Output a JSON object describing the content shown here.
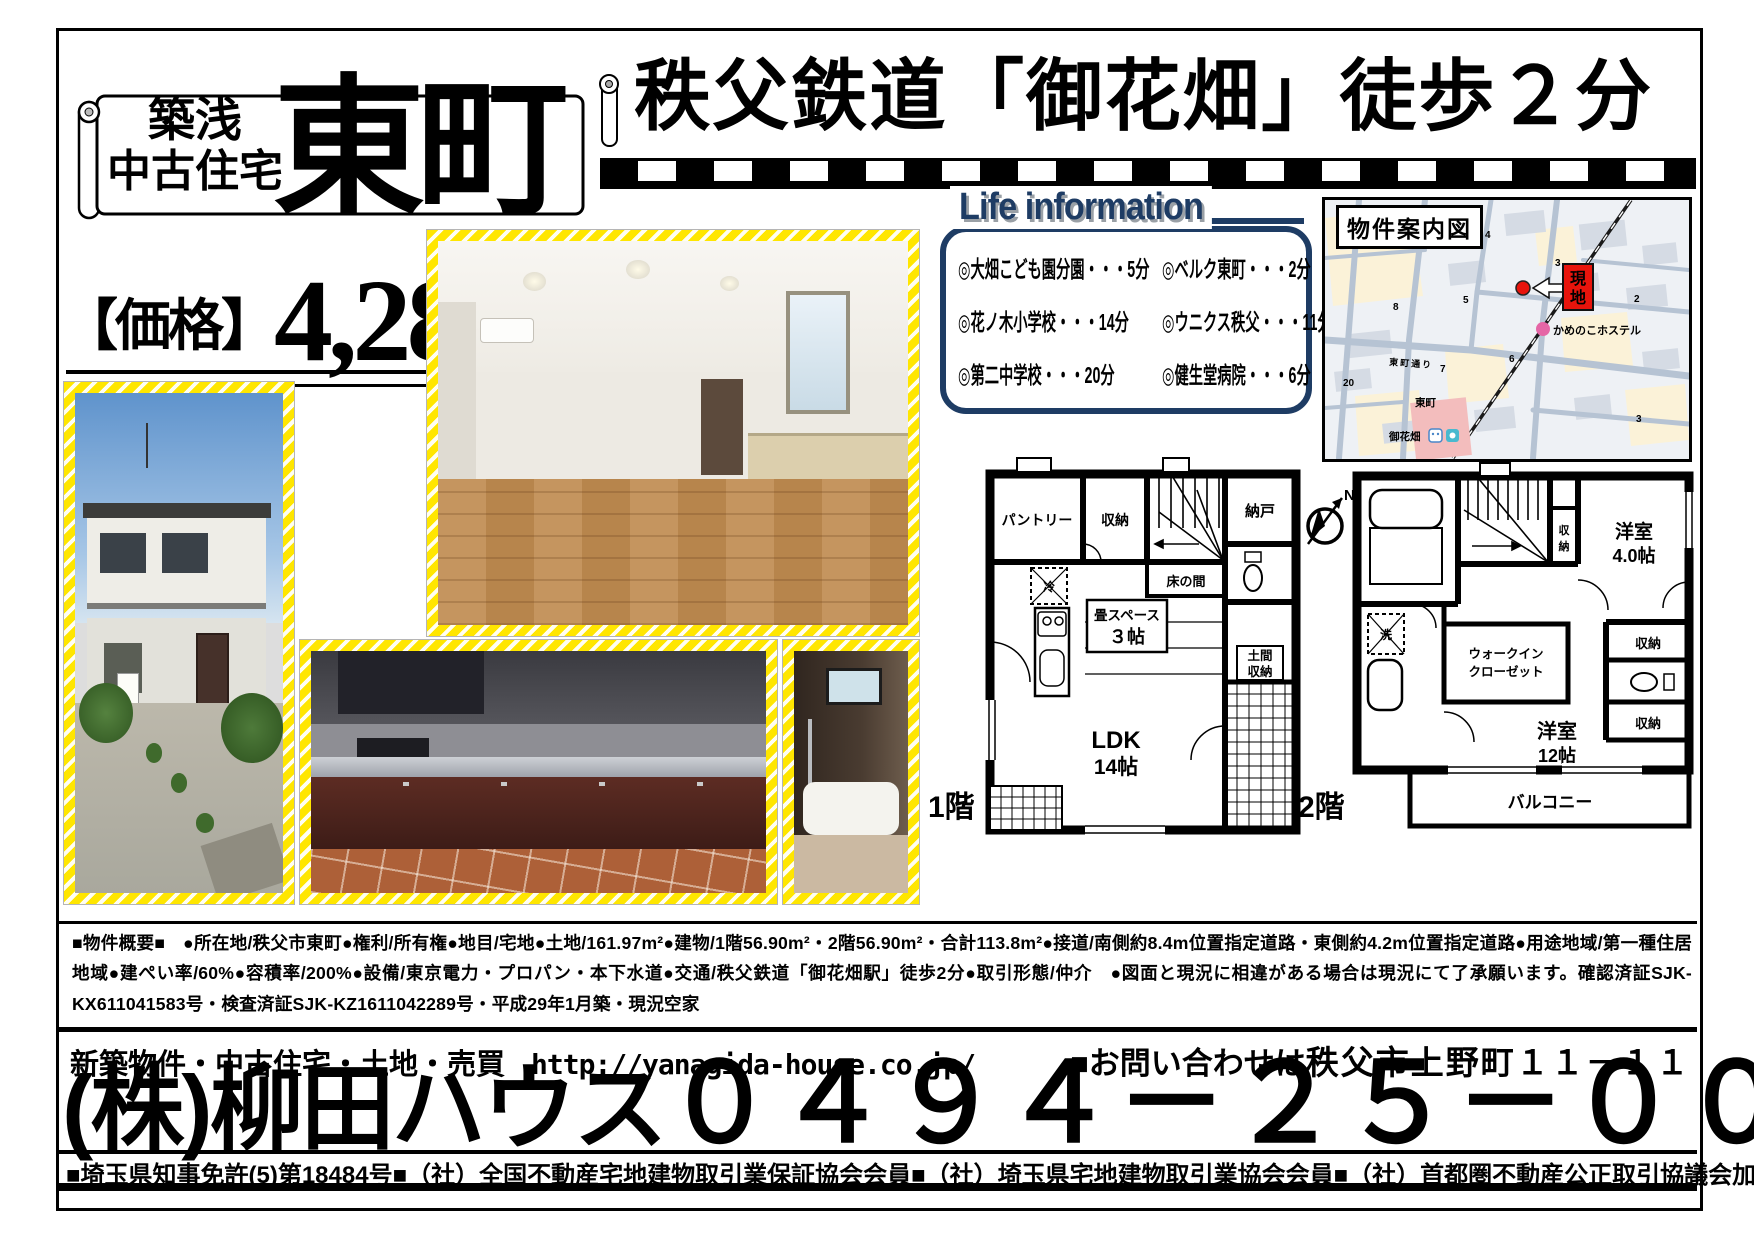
{
  "banner": {
    "tag1": "築浅",
    "tag2": "中古住宅",
    "name": "東町"
  },
  "headline": "秩父鉄道「御花畑」徒歩２分",
  "price": {
    "label": "【価格】",
    "amount": "4,280",
    "unit": "万円"
  },
  "life": {
    "title": "Life information",
    "rows": [
      {
        "l": "◎大畑こども園分園・・・5分",
        "r": "◎ベルク東町・・・2分"
      },
      {
        "l": "◎花ノ木小学校・・・14分",
        "r": "◎ウニクス秩父・・・11分"
      },
      {
        "l": "◎第二中学校・・・20分",
        "r": "◎健生堂病院・・・6分"
      }
    ]
  },
  "map": {
    "title": "物件案内図",
    "site_chars": [
      "現",
      "地"
    ],
    "hostel": "かめのこホステル",
    "town": "東町",
    "station": "御花畑",
    "road": "東町通り",
    "numbers": [
      "4",
      "5",
      "8",
      "3",
      "1",
      "2",
      "7",
      "6",
      "20",
      "3"
    ]
  },
  "compass": "N",
  "floor1": {
    "label": "1階",
    "pantry": "パントリー",
    "closet": "収納",
    "nando": "納戸",
    "tokonoma": "床の間",
    "tatami_1": "畳スペース",
    "tatami_2": "３帖",
    "fridge": "冷",
    "doma_1": "土間",
    "doma_2": "収納",
    "ldk_1": "LDK",
    "ldk_2": "14帖"
  },
  "floor2": {
    "label": "2階",
    "room4_1": "洋室",
    "room4_2": "4.0帖",
    "stair_closet_chars": [
      "収",
      "納"
    ],
    "wash": "洗",
    "wic_1": "ウォークイン",
    "wic_2": "クローゼット",
    "closet_a": "収納",
    "closet_b": "収納",
    "room12_1": "洋室",
    "room12_2": "12帖",
    "balcony": "バルコニー"
  },
  "summary": "■物件概要■　●所在地/秩父市東町●権利/所有権●地目/宅地●土地/161.97m²●建物/1階56.90m²・2階56.90m²・合計113.8m²●接道/南側約8.4m位置指定道路・東側約4.2m位置指定道路●用途地域/第一種住居地域●建ぺい率/60%●容積率/200%●設備/東京電力・プロパン・本下水道●交通/秩父鉄道「御花畑駅」徒歩2分●取引形態/仲介　●図面と現況に相違がある場合は現況にて了承願います。確認済証SJK-KX611041583号・検査済証SJK-KZ1611042289号・平成29年1月築・現況空家",
  "footer": {
    "services": "新築物件・中古住宅・土地・売買",
    "url": "http://yanagida-house.co.jp/",
    "contact": "■お問い合わせは",
    "address": "秩父市上野町１１－１１",
    "company": "(株)柳田ハウス",
    "phone": "０４９４－２５－００３８",
    "licenses": [
      "■埼玉県知事免許(5)第18484号",
      "■（社）全国不動産宅地建物取引業保証協会会員",
      "■（社）埼玉県宅地建物取引業協会会員",
      "■（社）首都圏不動産公正取引協議会加盟"
    ]
  },
  "colors": {
    "accent_yellow": "#ffe600",
    "navy": "#1e3c64",
    "marker_red": "#e8140c",
    "hostel_pink": "#e566a6"
  }
}
